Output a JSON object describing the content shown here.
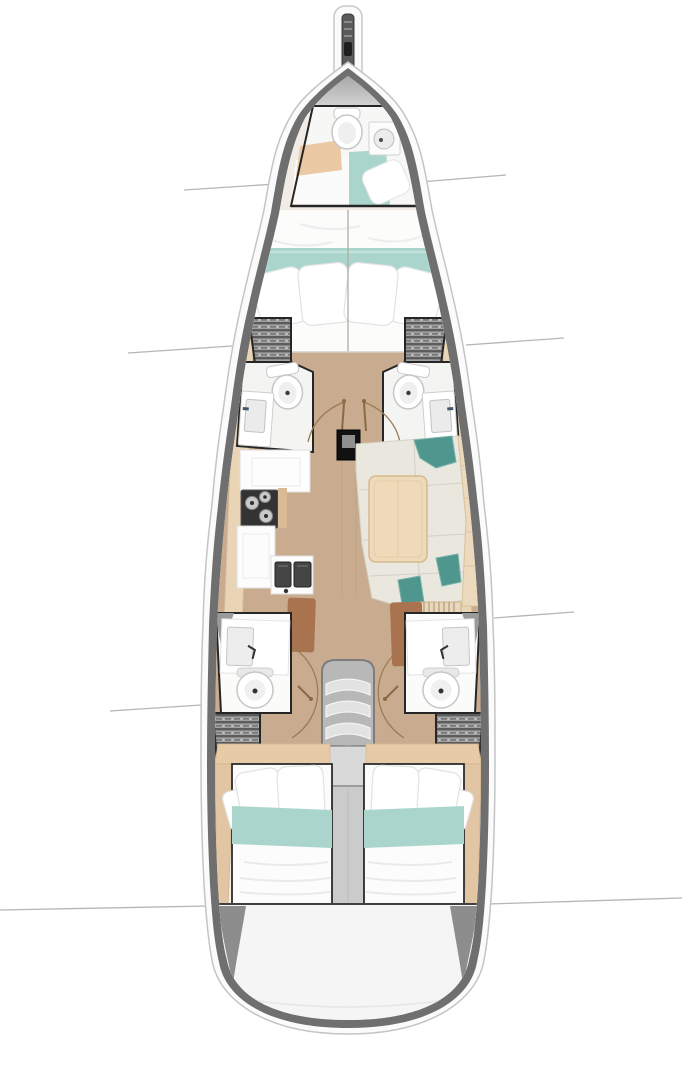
{
  "diagram": {
    "type": "yacht-interior-floorplan",
    "view": "top-down",
    "orientation": "bow-up",
    "visible_text": [],
    "palette": {
      "background": "#ffffff",
      "hull_outline": "#c4c4c4",
      "hull_deck_white": "#fbfbfb",
      "hull_wall_gray": "#6f6f6f",
      "floor_wood": "#c9ac8f",
      "shelf_wood": "#e9d4b6",
      "bedding_white": "#fcfcfc",
      "blanket_teal": "#a9d5cd",
      "cushion_teal": "#4f968e",
      "rug_terracotta": "#a8734e",
      "fixture_white": "#f7f7f6",
      "appliance_dark": "#333333",
      "locker_slat_gray": "#5c5c5c",
      "compartment_outline": "#262626",
      "door_arc_brown": "#9b7c55",
      "callout_line": "#b5b5b5",
      "mast_black": "#111111",
      "step_gray": "#e2e2e2",
      "transom_white": "#f5f5f5"
    },
    "areas": {
      "bowsprit": "Bowsprit with anchor roller",
      "forepeak": "Forepeak crew cabin with toilet, round-basin sink, shelf and small berth",
      "forward_cabin": "Forward owner cabin with double berth, teal runner and pillows",
      "port_head": "Port forward head with slatted hanging locker, toilet and sink",
      "starboard_head": "Starboard forward head with slatted hanging locker, toilet and sink",
      "mast": "Mast step at corridor",
      "galley": "Port galley with three-burner stove, cabinets and double sink",
      "salon": "Starboard salon with U-shaped settee, teal cushions and table",
      "port_aft_head": "Port aft head with sink counter and toilet",
      "starboard_aft_head": "Starboard aft head with sink counter and toilet",
      "companionway": "Companionway with four steps, landing and engine compartment strip",
      "port_aft_cabin": "Port aft cabin with double berth, teal runner and pillows",
      "starboard_aft_cabin": "Starboard aft cabin with double berth, teal runner and pillows",
      "transom": "Rounded transom / aft deck",
      "callouts": "Bulkhead call-out lines extending beyond the hull"
    },
    "fixture_counts": {
      "toilets": 5,
      "sinks": 5,
      "double_berths": 3,
      "small_berths": 1,
      "stove_burners": 3,
      "galley_sink_basins": 2,
      "companionway_steps": 4,
      "slatted_lockers": 4,
      "door_swing_arcs": 4,
      "terracotta_rugs": 2
    }
  }
}
